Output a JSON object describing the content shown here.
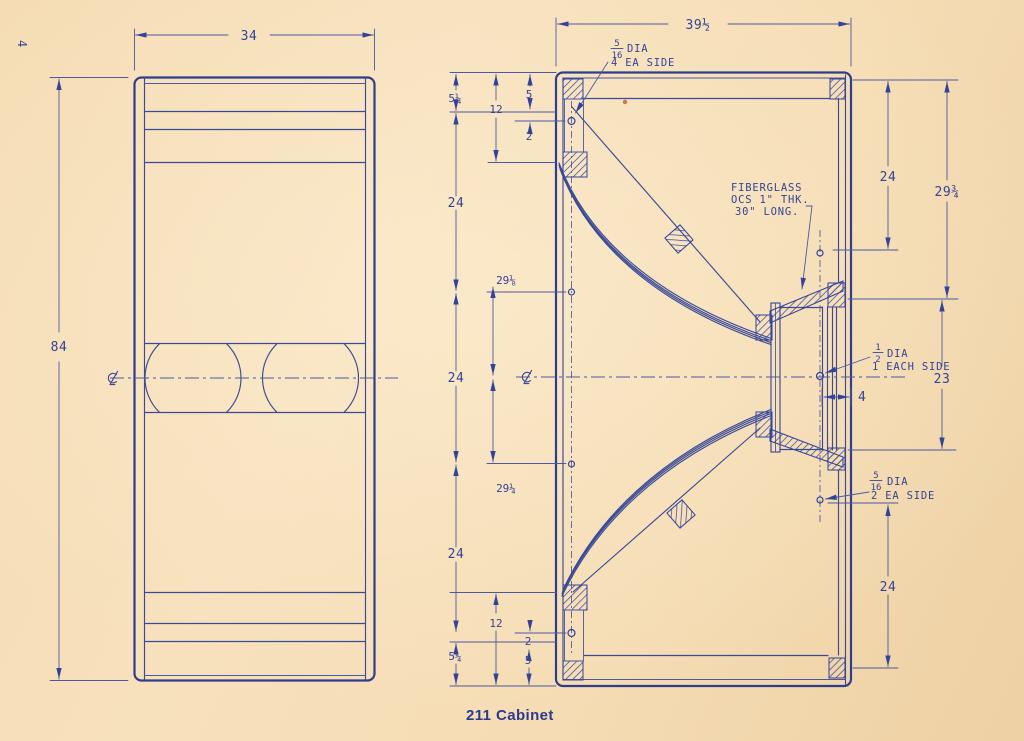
{
  "page": {
    "number": "4",
    "caption": "211 Cabinet",
    "paper_color": "#f5dcb4",
    "ink_color": "#3a4a97",
    "heavy_ink_color": "#2e3e8c",
    "caption_color": "#2b3a8e"
  },
  "front_view": {
    "width_dim": "34",
    "height_dim": "84",
    "centerline_symbol": "℄"
  },
  "section_view": {
    "width_dim": "39½",
    "centerline_symbol": "℄",
    "left_dims": {
      "outer_top": "5¼",
      "twelve_top": "12",
      "five_top": "5",
      "two_top": "2",
      "upper_24": "24",
      "upper_29": "29⅛",
      "center_24": "24",
      "lower_29": "29¼",
      "lower_24": "24",
      "twelve_bottom": "12",
      "two_bottom": "2",
      "five_bottom": "5",
      "outer_bottom": "5¼"
    },
    "right_dims": {
      "upper_24": "24",
      "upper_29": "29¾",
      "center_23": "23",
      "depth_4": "4",
      "lower_24": "24"
    }
  },
  "notes": {
    "front_holes": {
      "frac_num": "5",
      "frac_den": "16",
      "dia": "DIA",
      "qty": "4 EA SIDE"
    },
    "fiberglass": {
      "line1": "FIBERGLASS",
      "line2": "OCS 1\" THK.",
      "line3": "30\" LONG."
    },
    "rear_hole_mid": {
      "frac_num": "1",
      "frac_den": "2",
      "dia": "DIA",
      "qty": "1 EACH SIDE"
    },
    "rear_holes_low": {
      "frac_num": "5",
      "frac_den": "16",
      "dia": "DIA",
      "qty": "2 EA SIDE"
    }
  }
}
